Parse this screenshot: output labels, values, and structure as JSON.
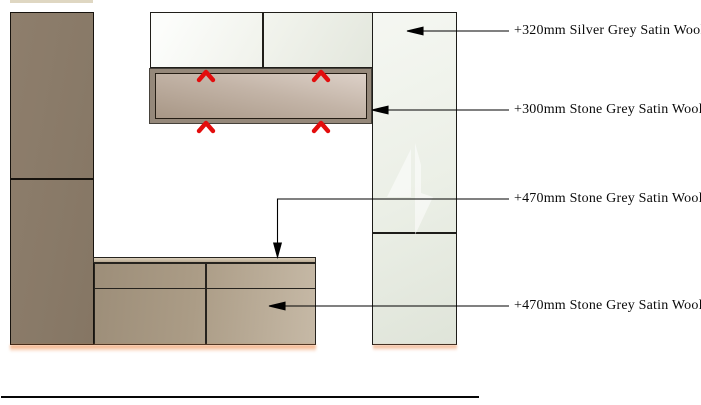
{
  "drawing": {
    "type": "cabinet-elevation",
    "annotations": [
      {
        "label": "+320mm Silver Grey Satin Wool"
      },
      {
        "label": "+300mm Stone Grey Satin Wool"
      },
      {
        "label": "+470mm Stone Grey Satin Wool"
      },
      {
        "label": "+470mm Stone Grey Satin Wool"
      }
    ],
    "icons": {
      "chevron_marker": "red upward chevron ^ (4 placed on stone grey panel)"
    },
    "colors": {
      "tall_left_cabinet": "#8a7b67",
      "upper_cabinet_white": "#eff1ea",
      "right_cabinet_silver_grey": "#edf0e9",
      "stone_panel_frame": "#95887a",
      "stone_panel_fill_dark": "#a89786",
      "stone_panel_fill_light": "#ddd1c8",
      "base_cabinet_dark": "#9d8e79",
      "base_cabinet_light": "#c6b9a6",
      "marker_red": "#e30d0d",
      "underglow_orange": "#ec803a",
      "line_black": "#000000"
    }
  }
}
